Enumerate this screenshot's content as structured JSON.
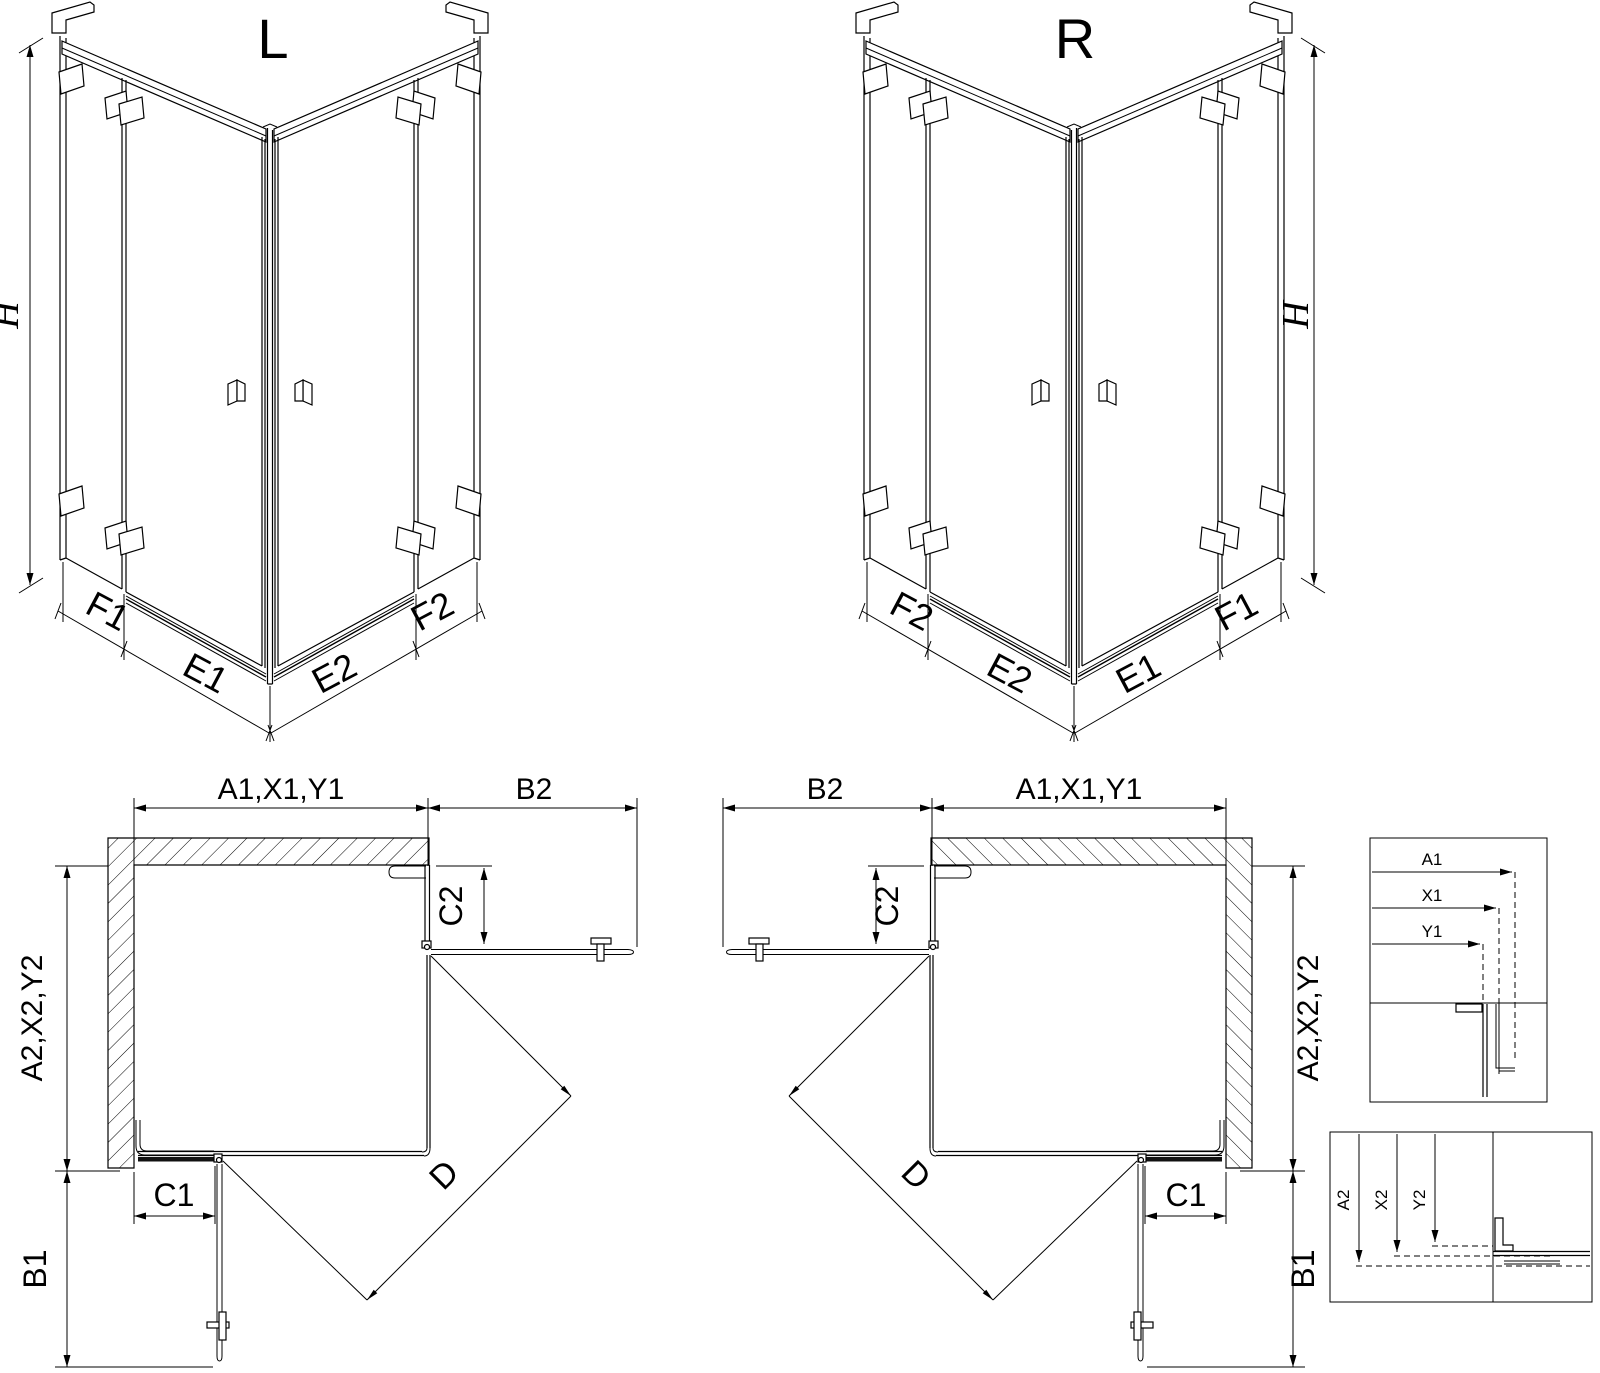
{
  "colors": {
    "line": "#000000",
    "bg": "#ffffff"
  },
  "iso_left": {
    "title": "L",
    "h": "H",
    "f1": "F1",
    "e1": "E1",
    "e2": "E2",
    "f2": "F2"
  },
  "iso_right": {
    "title": "R",
    "h": "H",
    "f1": "F1",
    "e1": "E1",
    "e2": "E2",
    "f2": "F2"
  },
  "plan_left": {
    "a1": "A1,X1,Y1",
    "b2": "B2",
    "c2": "C2",
    "a2": "A2,X2,Y2",
    "b1": "B1",
    "c1": "C1",
    "d": "D"
  },
  "plan_right": {
    "a1": "A1,X1,Y1",
    "b2": "B2",
    "c2": "C2",
    "a2": "A2,X2,Y2",
    "b1": "B1",
    "c1": "C1",
    "d": "D"
  },
  "detail_top": {
    "a1": "A1",
    "x1": "X1",
    "y1": "Y1"
  },
  "detail_bottom": {
    "a2": "A2",
    "x2": "X2",
    "y2": "Y2"
  }
}
